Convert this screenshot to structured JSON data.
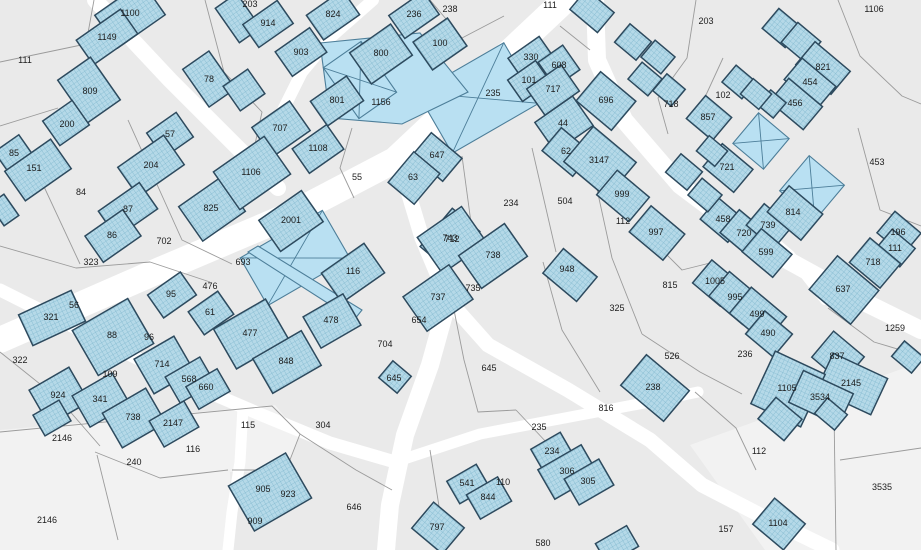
{
  "map": {
    "background": "#eaeaea",
    "light_zone_fill": "#f2f2f2",
    "road_color": "#ffffff",
    "parcel_line_color": "#9b9b9b",
    "building_fill": "#b5d9e8",
    "building_hatch_color": "#82b9cf",
    "building_stroke": "#2d4a5e",
    "highlight_fill": "#b9e0f2",
    "highlight_stroke": "#4d7e99",
    "label_color": "#1c1c1c",
    "labels": [
      [
        25,
        60,
        "111"
      ],
      [
        130,
        13,
        "1100"
      ],
      [
        107,
        37,
        "1149"
      ],
      [
        90,
        91,
        "809"
      ],
      [
        67,
        124,
        "200"
      ],
      [
        209,
        79,
        "78"
      ],
      [
        170,
        134,
        "57"
      ],
      [
        250,
        4,
        "203"
      ],
      [
        268,
        23,
        "914"
      ],
      [
        333,
        14,
        "824"
      ],
      [
        301,
        52,
        "903"
      ],
      [
        414,
        14,
        "236"
      ],
      [
        450,
        9,
        "238"
      ],
      [
        440,
        43,
        "100"
      ],
      [
        381,
        53,
        "800"
      ],
      [
        337,
        100,
        "801"
      ],
      [
        381,
        102,
        "1156"
      ],
      [
        280,
        128,
        "707"
      ],
      [
        550,
        5,
        "111"
      ],
      [
        531,
        57,
        "330"
      ],
      [
        559,
        65,
        "608"
      ],
      [
        529,
        80,
        "101"
      ],
      [
        553,
        89,
        "717"
      ],
      [
        493,
        93,
        "235"
      ],
      [
        606,
        100,
        "696"
      ],
      [
        671,
        104,
        "718"
      ],
      [
        563,
        123,
        "44"
      ],
      [
        706,
        21,
        "203"
      ],
      [
        874,
        9,
        "1106"
      ],
      [
        723,
        95,
        "102"
      ],
      [
        823,
        67,
        "821"
      ],
      [
        810,
        82,
        "454"
      ],
      [
        795,
        103,
        "456"
      ],
      [
        708,
        117,
        "857"
      ],
      [
        14,
        153,
        "85"
      ],
      [
        34,
        168,
        "151"
      ],
      [
        81,
        192,
        "84"
      ],
      [
        151,
        165,
        "204"
      ],
      [
        128,
        209,
        "87"
      ],
      [
        112,
        235,
        "86"
      ],
      [
        164,
        241,
        "702"
      ],
      [
        91,
        262,
        "323"
      ],
      [
        211,
        208,
        "825"
      ],
      [
        318,
        148,
        "1108"
      ],
      [
        251,
        172,
        "1106"
      ],
      [
        357,
        177,
        "55"
      ],
      [
        437,
        155,
        "647"
      ],
      [
        413,
        177,
        "63"
      ],
      [
        291,
        220,
        "2001"
      ],
      [
        243,
        262,
        "693"
      ],
      [
        353,
        271,
        "116"
      ],
      [
        450,
        238,
        "743"
      ],
      [
        566,
        151,
        "62"
      ],
      [
        599,
        160,
        "3147"
      ],
      [
        511,
        203,
        "234"
      ],
      [
        565,
        201,
        "504"
      ],
      [
        622,
        194,
        "999"
      ],
      [
        623,
        221,
        "112"
      ],
      [
        656,
        232,
        "997"
      ],
      [
        877,
        162,
        "453"
      ],
      [
        727,
        167,
        "721"
      ],
      [
        723,
        219,
        "458"
      ],
      [
        744,
        233,
        "720"
      ],
      [
        768,
        225,
        "739"
      ],
      [
        793,
        212,
        "814"
      ],
      [
        766,
        252,
        "599"
      ],
      [
        898,
        232,
        "196"
      ],
      [
        895,
        248,
        "111"
      ],
      [
        873,
        262,
        "718"
      ],
      [
        171,
        294,
        "95"
      ],
      [
        210,
        286,
        "476"
      ],
      [
        74,
        305,
        "56"
      ],
      [
        51,
        317,
        "321"
      ],
      [
        210,
        312,
        "61"
      ],
      [
        112,
        335,
        "88"
      ],
      [
        149,
        337,
        "96"
      ],
      [
        20,
        360,
        "322"
      ],
      [
        110,
        374,
        "109"
      ],
      [
        162,
        364,
        "714"
      ],
      [
        189,
        379,
        "568"
      ],
      [
        206,
        387,
        "660"
      ],
      [
        58,
        395,
        "924"
      ],
      [
        100,
        399,
        "341"
      ],
      [
        250,
        333,
        "477"
      ],
      [
        331,
        320,
        "478"
      ],
      [
        286,
        361,
        "848"
      ],
      [
        385,
        344,
        "704"
      ],
      [
        419,
        320,
        "654"
      ],
      [
        394,
        378,
        "645"
      ],
      [
        452,
        239,
        "712"
      ],
      [
        493,
        255,
        "738"
      ],
      [
        438,
        297,
        "737"
      ],
      [
        473,
        288,
        "735"
      ],
      [
        567,
        269,
        "948"
      ],
      [
        617,
        308,
        "325"
      ],
      [
        670,
        285,
        "815"
      ],
      [
        672,
        356,
        "526"
      ],
      [
        489,
        368,
        "645"
      ],
      [
        653,
        387,
        "238"
      ],
      [
        606,
        408,
        "816"
      ],
      [
        715,
        281,
        "1005"
      ],
      [
        735,
        297,
        "995"
      ],
      [
        757,
        314,
        "499"
      ],
      [
        768,
        333,
        "490"
      ],
      [
        843,
        289,
        "637"
      ],
      [
        895,
        328,
        "1259"
      ],
      [
        745,
        354,
        "236"
      ],
      [
        837,
        356,
        "837"
      ],
      [
        851,
        383,
        "2145"
      ],
      [
        787,
        388,
        "1105"
      ],
      [
        820,
        397,
        "3534"
      ],
      [
        62,
        438,
        "2146"
      ],
      [
        47,
        520,
        "2146"
      ],
      [
        134,
        462,
        "240"
      ],
      [
        133,
        417,
        "738"
      ],
      [
        173,
        423,
        "2147"
      ],
      [
        193,
        449,
        "116"
      ],
      [
        248,
        425,
        "115"
      ],
      [
        323,
        425,
        "304"
      ],
      [
        263,
        489,
        "905"
      ],
      [
        288,
        494,
        "923"
      ],
      [
        255,
        521,
        "909"
      ],
      [
        354,
        507,
        "646"
      ],
      [
        437,
        527,
        "797"
      ],
      [
        539,
        427,
        "235"
      ],
      [
        552,
        451,
        "234"
      ],
      [
        567,
        471,
        "306"
      ],
      [
        588,
        481,
        "305"
      ],
      [
        503,
        482,
        "110"
      ],
      [
        467,
        483,
        "541"
      ],
      [
        488,
        497,
        "844"
      ],
      [
        543,
        543,
        "580"
      ],
      [
        759,
        451,
        "112"
      ],
      [
        882,
        487,
        "3535"
      ],
      [
        726,
        529,
        "157"
      ],
      [
        778,
        523,
        "1104"
      ]
    ],
    "buildings": [
      [
        130,
        15,
        58,
        40,
        -35
      ],
      [
        107,
        37,
        54,
        30,
        -35
      ],
      [
        89,
        90,
        40,
        52,
        -35
      ],
      [
        66,
        123,
        36,
        30,
        -35
      ],
      [
        209,
        79,
        32,
        46,
        -35
      ],
      [
        170,
        135,
        36,
        30,
        -35
      ],
      [
        14,
        154,
        30,
        26,
        -35
      ],
      [
        38,
        170,
        56,
        36,
        -35
      ],
      [
        4,
        210,
        18,
        26,
        -35
      ],
      [
        238,
        18,
        26,
        42,
        -35
      ],
      [
        268,
        24,
        42,
        28,
        -35
      ],
      [
        333,
        15,
        44,
        30,
        -35
      ],
      [
        301,
        52,
        42,
        30,
        -35
      ],
      [
        244,
        90,
        30,
        30,
        -35
      ],
      [
        281,
        129,
        46,
        36,
        -35
      ],
      [
        381,
        54,
        50,
        38,
        -35
      ],
      [
        440,
        44,
        42,
        34,
        -35
      ],
      [
        414,
        15,
        42,
        28,
        -35
      ],
      [
        337,
        101,
        44,
        30,
        -35
      ],
      [
        592,
        11,
        36,
        26,
        40
      ],
      [
        531,
        58,
        38,
        26,
        -35
      ],
      [
        559,
        66,
        30,
        30,
        -35
      ],
      [
        529,
        81,
        34,
        26,
        -35
      ],
      [
        553,
        90,
        42,
        32,
        -35
      ],
      [
        564,
        124,
        46,
        36,
        -35
      ],
      [
        606,
        101,
        46,
        38,
        40
      ],
      [
        633,
        42,
        28,
        24,
        40
      ],
      [
        658,
        57,
        26,
        22,
        40
      ],
      [
        645,
        79,
        26,
        22,
        40
      ],
      [
        669,
        90,
        24,
        22,
        40
      ],
      [
        782,
        28,
        30,
        26,
        40
      ],
      [
        801,
        42,
        30,
        26,
        40
      ],
      [
        823,
        68,
        46,
        30,
        40
      ],
      [
        810,
        83,
        44,
        28,
        40
      ],
      [
        796,
        104,
        44,
        30,
        40
      ],
      [
        772,
        104,
        20,
        20,
        40
      ],
      [
        709,
        118,
        34,
        30,
        40
      ],
      [
        739,
        82,
        26,
        22,
        40
      ],
      [
        756,
        94,
        24,
        20,
        40
      ],
      [
        151,
        166,
        56,
        36,
        -35
      ],
      [
        128,
        210,
        50,
        32,
        -35
      ],
      [
        113,
        236,
        46,
        32,
        -35
      ],
      [
        212,
        209,
        52,
        42,
        -35
      ],
      [
        318,
        149,
        42,
        30,
        -35
      ],
      [
        252,
        173,
        62,
        46,
        -35
      ],
      [
        291,
        221,
        52,
        38,
        -35
      ],
      [
        353,
        273,
        52,
        36,
        -35
      ],
      [
        437,
        157,
        40,
        30,
        40
      ],
      [
        414,
        178,
        34,
        40,
        40
      ],
      [
        450,
        239,
        36,
        50,
        40
      ],
      [
        567,
        152,
        40,
        30,
        40
      ],
      [
        600,
        162,
        56,
        46,
        40
      ],
      [
        623,
        196,
        42,
        32,
        40
      ],
      [
        657,
        233,
        44,
        34,
        40
      ],
      [
        684,
        172,
        28,
        24,
        40
      ],
      [
        570,
        275,
        44,
        32,
        40
      ],
      [
        452,
        240,
        54,
        44,
        -35
      ],
      [
        493,
        256,
        56,
        40,
        -35
      ],
      [
        438,
        298,
        56,
        42,
        -35
      ],
      [
        728,
        168,
        40,
        30,
        40
      ],
      [
        712,
        151,
        24,
        20,
        40
      ],
      [
        723,
        220,
        36,
        28,
        40
      ],
      [
        745,
        234,
        40,
        30,
        40
      ],
      [
        769,
        226,
        36,
        28,
        40
      ],
      [
        795,
        213,
        44,
        34,
        40
      ],
      [
        767,
        253,
        40,
        30,
        40
      ],
      [
        899,
        233,
        34,
        28,
        40
      ],
      [
        896,
        248,
        30,
        24,
        40
      ],
      [
        875,
        263,
        40,
        32,
        40
      ],
      [
        705,
        195,
        26,
        22,
        40
      ],
      [
        172,
        295,
        40,
        28,
        -35
      ],
      [
        211,
        313,
        36,
        28,
        -35
      ],
      [
        52,
        318,
        58,
        34,
        -25
      ],
      [
        113,
        337,
        64,
        52,
        -30
      ],
      [
        164,
        365,
        46,
        40,
        -30
      ],
      [
        190,
        380,
        40,
        30,
        -30
      ],
      [
        208,
        389,
        36,
        26,
        -30
      ],
      [
        59,
        396,
        46,
        40,
        -30
      ],
      [
        101,
        400,
        46,
        36,
        -30
      ],
      [
        251,
        334,
        60,
        46,
        -30
      ],
      [
        332,
        321,
        46,
        36,
        -30
      ],
      [
        287,
        362,
        56,
        40,
        -30
      ],
      [
        395,
        377,
        24,
        22,
        40
      ],
      [
        655,
        388,
        56,
        40,
        40
      ],
      [
        716,
        283,
        36,
        30,
        40
      ],
      [
        736,
        298,
        44,
        32,
        40
      ],
      [
        758,
        315,
        46,
        34,
        40
      ],
      [
        769,
        334,
        36,
        30,
        40
      ],
      [
        844,
        290,
        54,
        44,
        40
      ],
      [
        838,
        357,
        40,
        34,
        40
      ],
      [
        852,
        384,
        60,
        40,
        25
      ],
      [
        788,
        389,
        55,
        58,
        25
      ],
      [
        821,
        398,
        55,
        35,
        25
      ],
      [
        908,
        357,
        26,
        20,
        40
      ],
      [
        134,
        418,
        50,
        40,
        -30
      ],
      [
        52,
        418,
        30,
        24,
        -30
      ],
      [
        174,
        424,
        40,
        30,
        -30
      ],
      [
        270,
        492,
        66,
        52,
        -30
      ],
      [
        438,
        528,
        40,
        34,
        40
      ],
      [
        468,
        484,
        34,
        26,
        -30
      ],
      [
        489,
        498,
        36,
        28,
        -30
      ],
      [
        552,
        452,
        34,
        26,
        -30
      ],
      [
        568,
        472,
        50,
        34,
        -30
      ],
      [
        589,
        482,
        40,
        30,
        -30
      ],
      [
        617,
        545,
        36,
        24,
        -30
      ],
      [
        780,
        419,
        34,
        28,
        40
      ],
      [
        831,
        414,
        26,
        20,
        40
      ],
      [
        779,
        524,
        40,
        34,
        40
      ]
    ],
    "highlights": [
      {
        "rect": [
          478,
          98,
          100,
          70,
          -30
        ],
        "cross": true
      },
      {
        "pts": "320,43 420,33 468,92 402,124 330,118",
        "cross": false
      },
      {
        "rect": [
          360,
          80,
          46,
          62,
          -35
        ],
        "cross": true
      },
      {
        "rect": [
          295,
          258,
          95,
          55,
          -30
        ],
        "cross": true
      },
      {
        "pts": "248,252 258,246 362,310 354,320",
        "cross": false
      },
      {
        "rect": [
          812,
          188,
          46,
          46,
          40
        ],
        "cross": true
      },
      {
        "rect": [
          761,
          141,
          40,
          40,
          40
        ],
        "cross": true
      }
    ],
    "roads": [
      {
        "p": "565,0 480,80 395,160 290,215 160,270 0,340",
        "w": 26
      },
      {
        "p": "95,0 170,80 240,150 278,188",
        "w": 16
      },
      {
        "p": "373,0 332,36 302,72 283,110 276,150",
        "w": 12
      },
      {
        "p": "595,0 597,60 624,120 680,185 760,245 860,300 921,330",
        "w": 18
      },
      {
        "p": "400,165 422,238 448,300 488,345 568,390 650,440 702,485 762,516 832,550",
        "w": 15
      },
      {
        "p": "448,300 430,365 405,435 390,505 386,550",
        "w": 18
      },
      {
        "p": "0,290 90,335 185,382 262,415 330,443 395,462",
        "w": 13
      },
      {
        "p": "395,462 480,434 570,417 660,400 698,392",
        "w": 11
      },
      {
        "p": "243,407 240,462 232,512 228,550",
        "w": 11
      },
      {
        "p": "825,300 790,255 770,238",
        "w": 10
      }
    ],
    "parcel_lines": [
      "0,62 86,44 94,0",
      "0,126 58,108",
      "26,148 80,264",
      "128,120 182,240 232,264",
      "0,246 76,268 150,262 210,282",
      "205,0 224,72 262,112 252,158",
      "430,0 462,38 504,16",
      "560,26 590,50",
      "696,0 687,58 658,98 668,134",
      "838,0 860,56 902,96 921,104",
      "858,128 880,210 921,226",
      "723,58 700,108",
      "532,148 556,252",
      "588,148 612,258 642,334",
      "462,156 472,230",
      "642,334 700,372 742,394",
      "648,236 682,270 714,262",
      "543,262 562,330 600,392",
      "0,432 272,406 300,434 286,470 232,470",
      "95,452 160,478 228,470",
      "97,455 118,540",
      "300,434 356,470 392,490",
      "430,450 446,550",
      "516,410 548,444",
      "452,300 464,360 478,412 516,410",
      "695,392 736,428 756,470",
      "828,308 874,342 921,356",
      "834,410 836,550",
      "840,460 921,448",
      "0,352 60,400 100,446",
      "352,128 340,168 354,198"
    ],
    "light_zones": [
      "0,430 275,405 300,435 285,472 230,472 232,550 0,550",
      "690,445 921,362 921,550 765,550"
    ]
  }
}
